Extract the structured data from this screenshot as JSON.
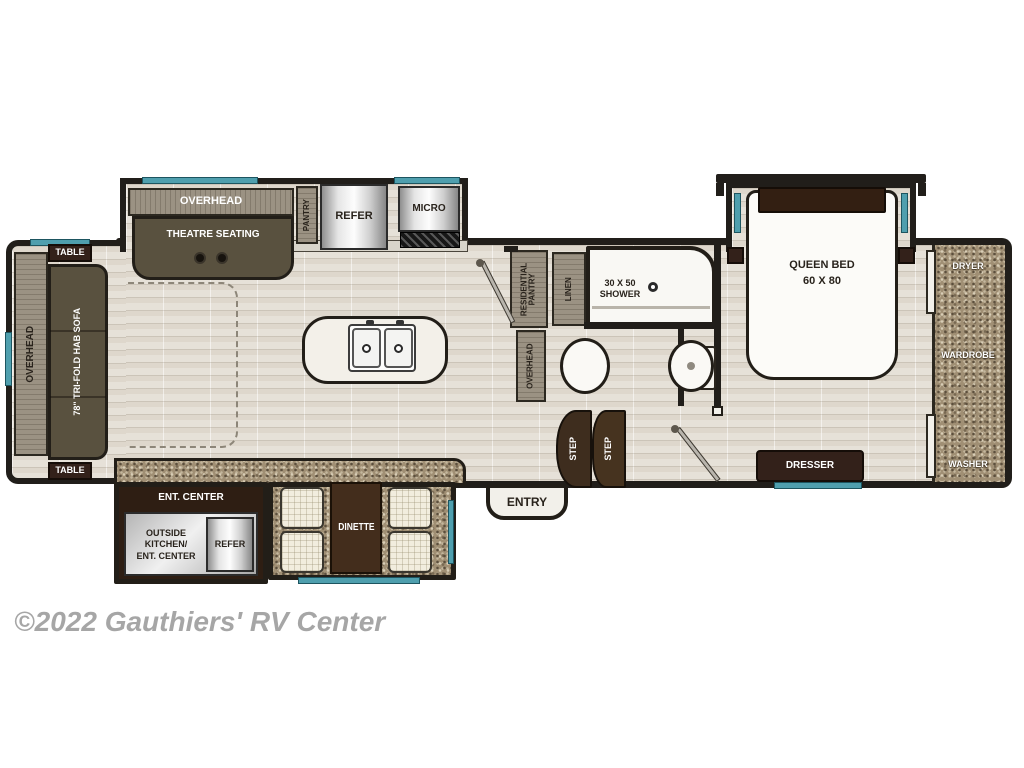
{
  "watermark": "©2022 Gauthiers' RV Center",
  "colors": {
    "wall": "#211e1a",
    "window_teal": "#4f9fae",
    "floor": "#e6e1d8",
    "counter_speckle": "#a08f74",
    "dark_wood": "#33211a",
    "sofa_seat": "#59513f",
    "cabinet_wood": "#9b9283",
    "appliance_silver": "#d9d9d9",
    "fixture_white": "#faf9f5",
    "watermark_gray": "#a6a6a6"
  },
  "floorplan": {
    "living": {
      "table_top": "TABLE",
      "table_bottom": "TABLE",
      "overhead": "OVERHEAD",
      "sofa": "78\" TRI-FOLD HAB SOFA",
      "theatre_overhead": "OVERHEAD",
      "theatre_seating": "THEATRE SEATING"
    },
    "kitchen": {
      "pantry": "PANTRY",
      "refer": "REFER",
      "micro": "MICRO"
    },
    "bath": {
      "residential_pantry_line1": "RESIDENTIAL",
      "residential_pantry_line2": "PANTRY",
      "overhead": "OVERHEAD",
      "linen": "LINEN",
      "shower_line1": "30 X 50",
      "shower_line2": "SHOWER"
    },
    "entryway": {
      "entry": "ENTRY",
      "step_upper": "STEP",
      "step_lower": "STEP"
    },
    "bedroom": {
      "bed_line1": "QUEEN BED",
      "bed_line2": "60 X 80",
      "dresser": "DRESSER"
    },
    "closet": {
      "dryer": "DRYER",
      "wardrobe": "WARDROBE",
      "washer": "WASHER"
    },
    "exterior_slide": {
      "ent_center": "ENT. CENTER",
      "outside_kitchen_line1": "OUTSIDE",
      "outside_kitchen_line2": "KITCHEN/",
      "outside_kitchen_line3": "ENT. CENTER",
      "refer": "REFER",
      "dinette": "DINETTE"
    }
  }
}
